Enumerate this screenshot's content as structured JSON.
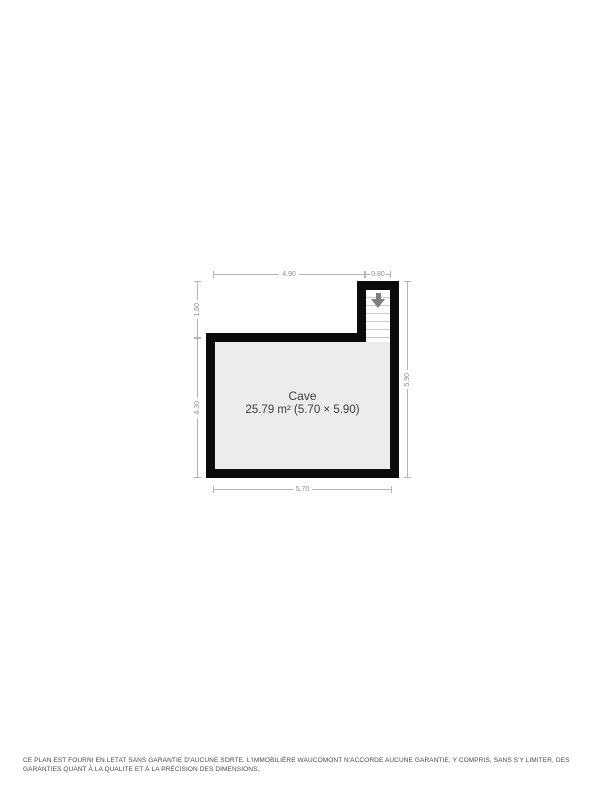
{
  "floorplan": {
    "room": {
      "name": "Cave",
      "area_label": "25.79 m² (5.70 × 5.90)"
    },
    "dimensions": {
      "top_left": "4.90",
      "top_right": "0.80",
      "left_upper": "1.60",
      "left_lower": "4.30",
      "right": "5.90",
      "bottom": "5.70"
    },
    "icons": {
      "stairs_arrow": "arrow-down"
    },
    "colors": {
      "wall": "#0b0b0b",
      "room_fill": "#ececec",
      "dimension_line": "#b5b5b5",
      "dimension_text": "#8f8f8f",
      "label_text": "#3c3c3c",
      "arrow": "#808080"
    }
  },
  "disclaimer": "CE PLAN EST FOURNI EN LETAT SANS GARANTIE D'AUCUNE SORTE. L'IMMOBILIÈRE WAUCOMONT N'ACCORDE AUCUNE GARANTIE, Y COMPRIS, SANS S'Y LIMITER, DES GARANTIES QUANT À LA QUALITE ET À LA PRÉCISION DES DIMENSIONS."
}
